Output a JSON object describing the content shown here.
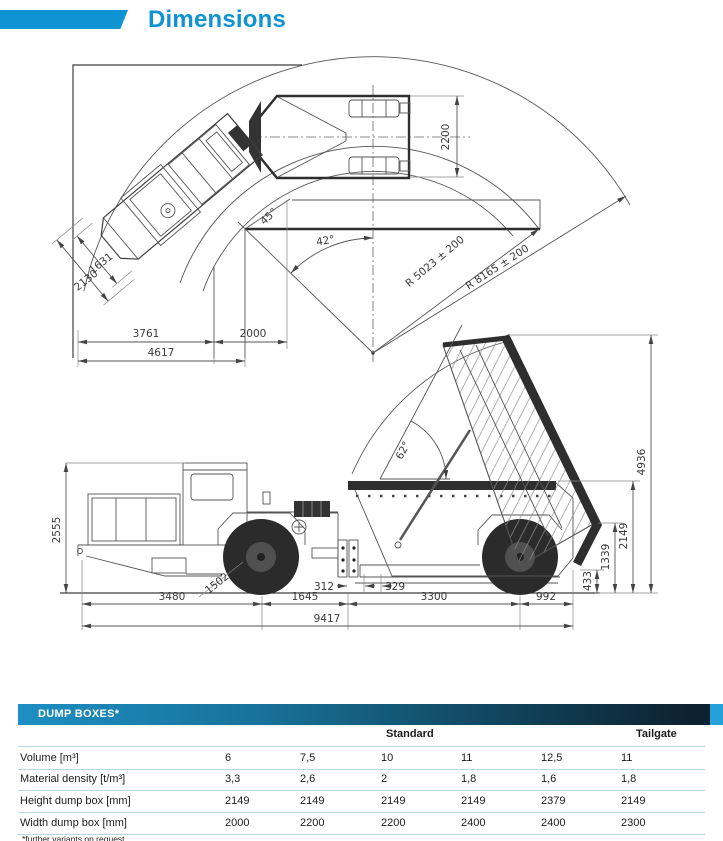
{
  "header": {
    "title": "Dimensions"
  },
  "colors": {
    "accent": "#0f93d2",
    "table_bar_left": "#1d8fc2",
    "table_bar_right": "#0d2231",
    "table_bar_cap": "#25a0d8",
    "row_separator": "#b9d7e8",
    "drawing_line": "#3f3f3f"
  },
  "top_view": {
    "dims": {
      "d2200": "2200",
      "d1631": "1631",
      "d2130": "2130",
      "d3761": "3761",
      "d2000": "2000",
      "d4617": "4617",
      "a45": "45°",
      "a42": "42°",
      "r_inner": "R 5023 ± 200",
      "r_outer": "R 8165 ± 200"
    }
  },
  "side_view": {
    "dims": {
      "d2555": "2555",
      "d1502": "1502",
      "d312": "312",
      "d329": "329",
      "d3480": "3480",
      "d1645": "1645",
      "d3300": "3300",
      "d992": "992",
      "d9417": "9417",
      "a62": "62°",
      "d4936": "4936",
      "d2149": "2149",
      "d1339": "1339",
      "d433": "433"
    }
  },
  "table": {
    "header": "DUMP BOXES*",
    "group_headers": {
      "standard": "Standard",
      "tailgate": "Tailgate"
    },
    "rows": [
      {
        "label": "Volume [m³]",
        "values": [
          "6",
          "7,5",
          "10",
          "11",
          "12,5",
          "11"
        ]
      },
      {
        "label": "Material density [t/m³]",
        "values": [
          "3,3",
          "2,6",
          "2",
          "1,8",
          "1,6",
          "1,8"
        ]
      },
      {
        "label": "Height dump box [mm]",
        "values": [
          "2149",
          "2149",
          "2149",
          "2149",
          "2379",
          "2149"
        ]
      },
      {
        "label": "Width dump box [mm]",
        "values": [
          "2000",
          "2200",
          "2200",
          "2400",
          "2400",
          "2300"
        ]
      }
    ],
    "footnote": "*further variants on request"
  }
}
